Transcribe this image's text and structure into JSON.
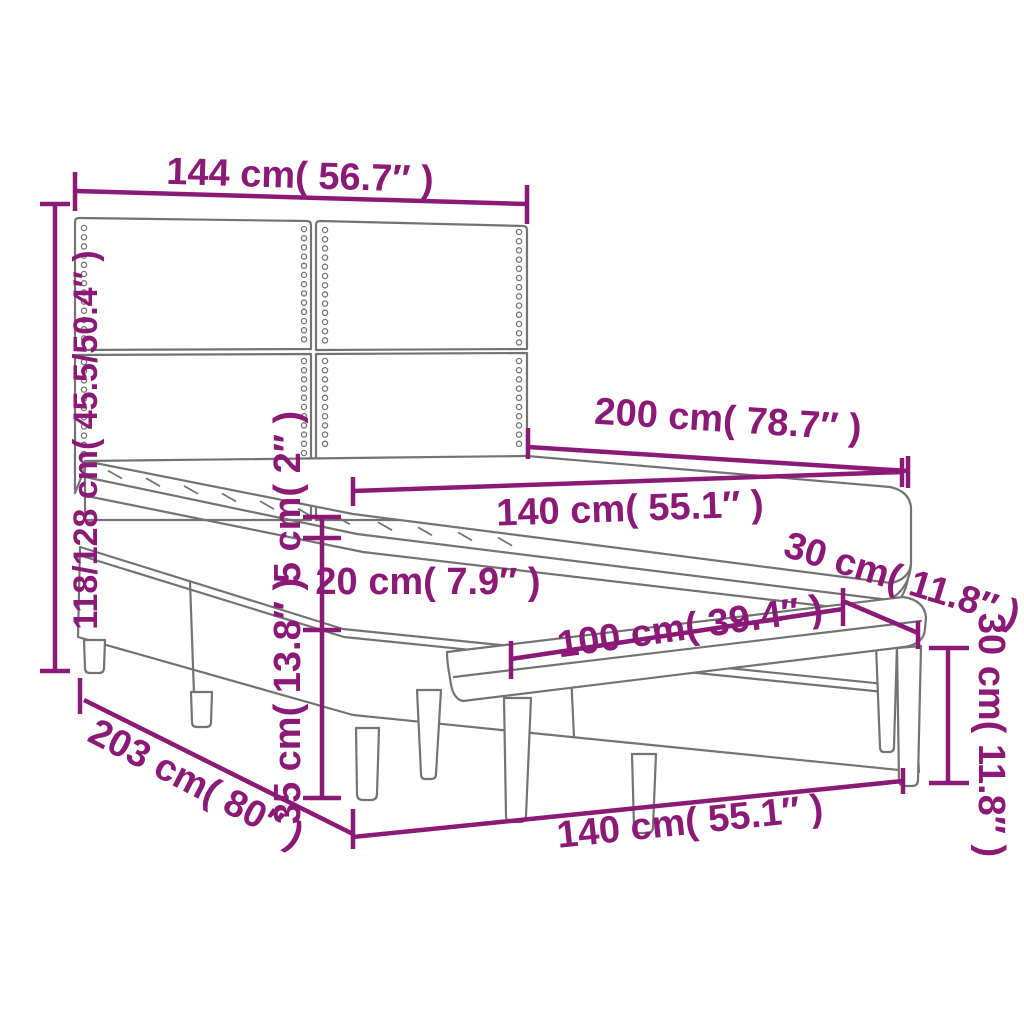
{
  "diagram": {
    "kind": "furniture-dimension-diagram",
    "subject": "box spring bed with upholstered headboard, mattress, topper and bench",
    "background_color": "#FFFFFF",
    "accent_color": "#8B1A76",
    "outline_color": "#737373",
    "dimensions": {
      "headboard_width": "144 cm( 56.7″ )",
      "overall_height": "118/128 cm( 45.5/50.4″ )",
      "bed_length": "200 cm( 78.7″ )",
      "mattress_width": "140 cm( 55.1″ )",
      "topper_height": "5 cm( 2″ )",
      "mattress_height": "20 cm( 7.9″ )",
      "base_height": "35 cm( 13.8″ )",
      "overall_length": "203 cm( 80″ )",
      "bench_length": "100 cm( 39.4″ )",
      "bench_depth": "30 cm( 11.8″ )",
      "bench_height": "30 cm( 11.8″ )",
      "bed_width_front": "140 cm( 55.1″ )"
    }
  }
}
